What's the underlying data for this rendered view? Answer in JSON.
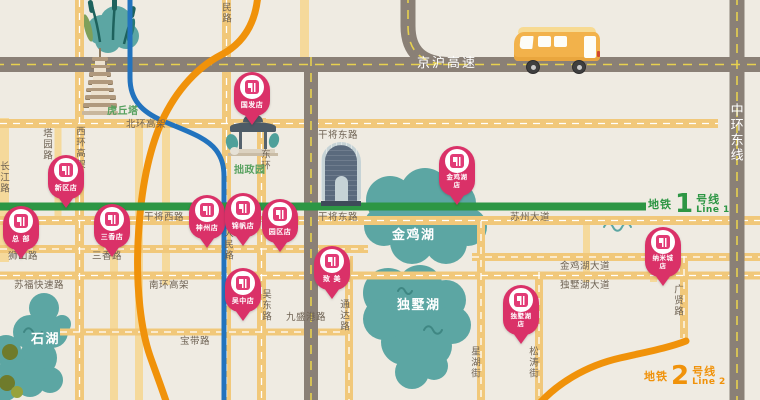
{
  "colors": {
    "background": "#EFEBE2",
    "road_yellow": "#F1C87A",
    "road_yellow_light": "#F5D99B",
    "highway_gray": "#8A8076",
    "highway_dash_yellow": "#E7D14F",
    "metro_line1_green": "#2D9644",
    "metro_line2_orange": "#F0920A",
    "river_blue": "#2273BE",
    "lake_teal": "#5CA6A3",
    "pin_pink": "#DA3168",
    "road_label_dark": "#6F6354",
    "landmark_label_green": "#57A15F"
  },
  "metro_lines": [
    {
      "prefix": "地铁",
      "number": "1",
      "suffix": "号线",
      "en": "Line 1",
      "color": "#2D9644"
    },
    {
      "prefix": "地铁",
      "number": "2",
      "suffix": "号线",
      "en": "Line 2",
      "color": "#F0920A"
    }
  ],
  "stores": [
    {
      "name": "国发店",
      "lines": [
        "国发店"
      ],
      "x": 252,
      "y": 126
    },
    {
      "name": "新区店",
      "lines": [
        "新区店"
      ],
      "x": 66,
      "y": 209
    },
    {
      "name": "总部",
      "lines": [
        "总 部"
      ],
      "x": 21,
      "y": 260
    },
    {
      "name": "三香店",
      "lines": [
        "三香店"
      ],
      "x": 112,
      "y": 258
    },
    {
      "name": "神州店",
      "lines": [
        "神州店"
      ],
      "x": 207,
      "y": 249
    },
    {
      "name": "锦帆店",
      "lines": [
        "锦帆店"
      ],
      "x": 243,
      "y": 247
    },
    {
      "name": "园区店",
      "lines": [
        "园区店"
      ],
      "x": 280,
      "y": 253
    },
    {
      "name": "金鸡湖店",
      "lines": [
        "金鸡湖",
        "店"
      ],
      "x": 457,
      "y": 206
    },
    {
      "name": "纳米城店",
      "lines": [
        "纳米城",
        "店"
      ],
      "x": 663,
      "y": 287
    },
    {
      "name": "独墅湖店",
      "lines": [
        "独墅湖",
        "店"
      ],
      "x": 521,
      "y": 345
    },
    {
      "name": "吴中店",
      "lines": [
        "吴中店"
      ],
      "x": 243,
      "y": 322
    },
    {
      "name": "致美",
      "lines": [
        "致 美"
      ],
      "x": 332,
      "y": 300
    }
  ],
  "labels": [
    {
      "text": "京沪高速",
      "kind": "highway",
      "x": 417,
      "y": 57,
      "vertical": false
    },
    {
      "text": "中环东线",
      "kind": "highway",
      "x": 728,
      "y": 103,
      "vertical": true
    },
    {
      "text": "北环高架",
      "kind": "road",
      "x": 126,
      "y": 120,
      "vertical": false
    },
    {
      "text": "干将东路",
      "kind": "road",
      "x": 318,
      "y": 131,
      "vertical": false
    },
    {
      "text": "干将西路",
      "kind": "road",
      "x": 144,
      "y": 213,
      "vertical": false
    },
    {
      "text": "干将东路",
      "kind": "road",
      "x": 318,
      "y": 213,
      "vertical": false
    },
    {
      "text": "苏州大道",
      "kind": "road",
      "x": 510,
      "y": 213,
      "vertical": false
    },
    {
      "text": "金鸡湖大道",
      "kind": "road",
      "x": 560,
      "y": 262,
      "vertical": false
    },
    {
      "text": "独墅湖大道",
      "kind": "road",
      "x": 560,
      "y": 281,
      "vertical": false
    },
    {
      "text": "狮山路",
      "kind": "road",
      "x": 8,
      "y": 252,
      "vertical": false
    },
    {
      "text": "三香路",
      "kind": "road",
      "x": 92,
      "y": 252,
      "vertical": false
    },
    {
      "text": "苏福快速路",
      "kind": "road",
      "x": 14,
      "y": 281,
      "vertical": false
    },
    {
      "text": "南环高架",
      "kind": "road",
      "x": 149,
      "y": 281,
      "vertical": false
    },
    {
      "text": "宝带路",
      "kind": "road",
      "x": 180,
      "y": 337,
      "vertical": false
    },
    {
      "text": "九盛港路",
      "kind": "road",
      "x": 286,
      "y": 313,
      "vertical": false
    },
    {
      "text": "塔园路",
      "kind": "road",
      "x": 41,
      "y": 128,
      "vertical": true
    },
    {
      "text": "西环高架",
      "kind": "road",
      "x": 74,
      "y": 126,
      "vertical": true
    },
    {
      "text": "长江路",
      "kind": "road",
      "x": -2,
      "y": 161,
      "vertical": true
    },
    {
      "text": "民路",
      "kind": "road",
      "x": 220,
      "y": 2,
      "vertical": true
    },
    {
      "text": "人民路",
      "kind": "road",
      "x": 222,
      "y": 228,
      "vertical": true
    },
    {
      "text": "东环",
      "kind": "road",
      "x": 259,
      "y": 149,
      "vertical": true
    },
    {
      "text": "吴东路",
      "kind": "road",
      "x": 260,
      "y": 289,
      "vertical": true
    },
    {
      "text": "通达路",
      "kind": "road",
      "x": 338,
      "y": 299,
      "vertical": true
    },
    {
      "text": "星湖街",
      "kind": "road",
      "x": 469,
      "y": 346,
      "vertical": true
    },
    {
      "text": "松涛街",
      "kind": "road",
      "x": 527,
      "y": 346,
      "vertical": true
    },
    {
      "text": "广贤路",
      "kind": "road",
      "x": 672,
      "y": 284,
      "vertical": true
    },
    {
      "text": "金鸡湖",
      "kind": "lake",
      "x": 392,
      "y": 229,
      "vertical": false
    },
    {
      "text": "独墅湖",
      "kind": "lake",
      "x": 397,
      "y": 299,
      "vertical": false
    },
    {
      "text": "石湖",
      "kind": "lake",
      "x": 31,
      "y": 333,
      "vertical": false
    },
    {
      "text": "虎丘塔",
      "kind": "landmark",
      "x": 107,
      "y": 107,
      "vertical": false
    },
    {
      "text": "拙政园",
      "kind": "landmark",
      "x": 234,
      "y": 166,
      "vertical": false
    }
  ]
}
